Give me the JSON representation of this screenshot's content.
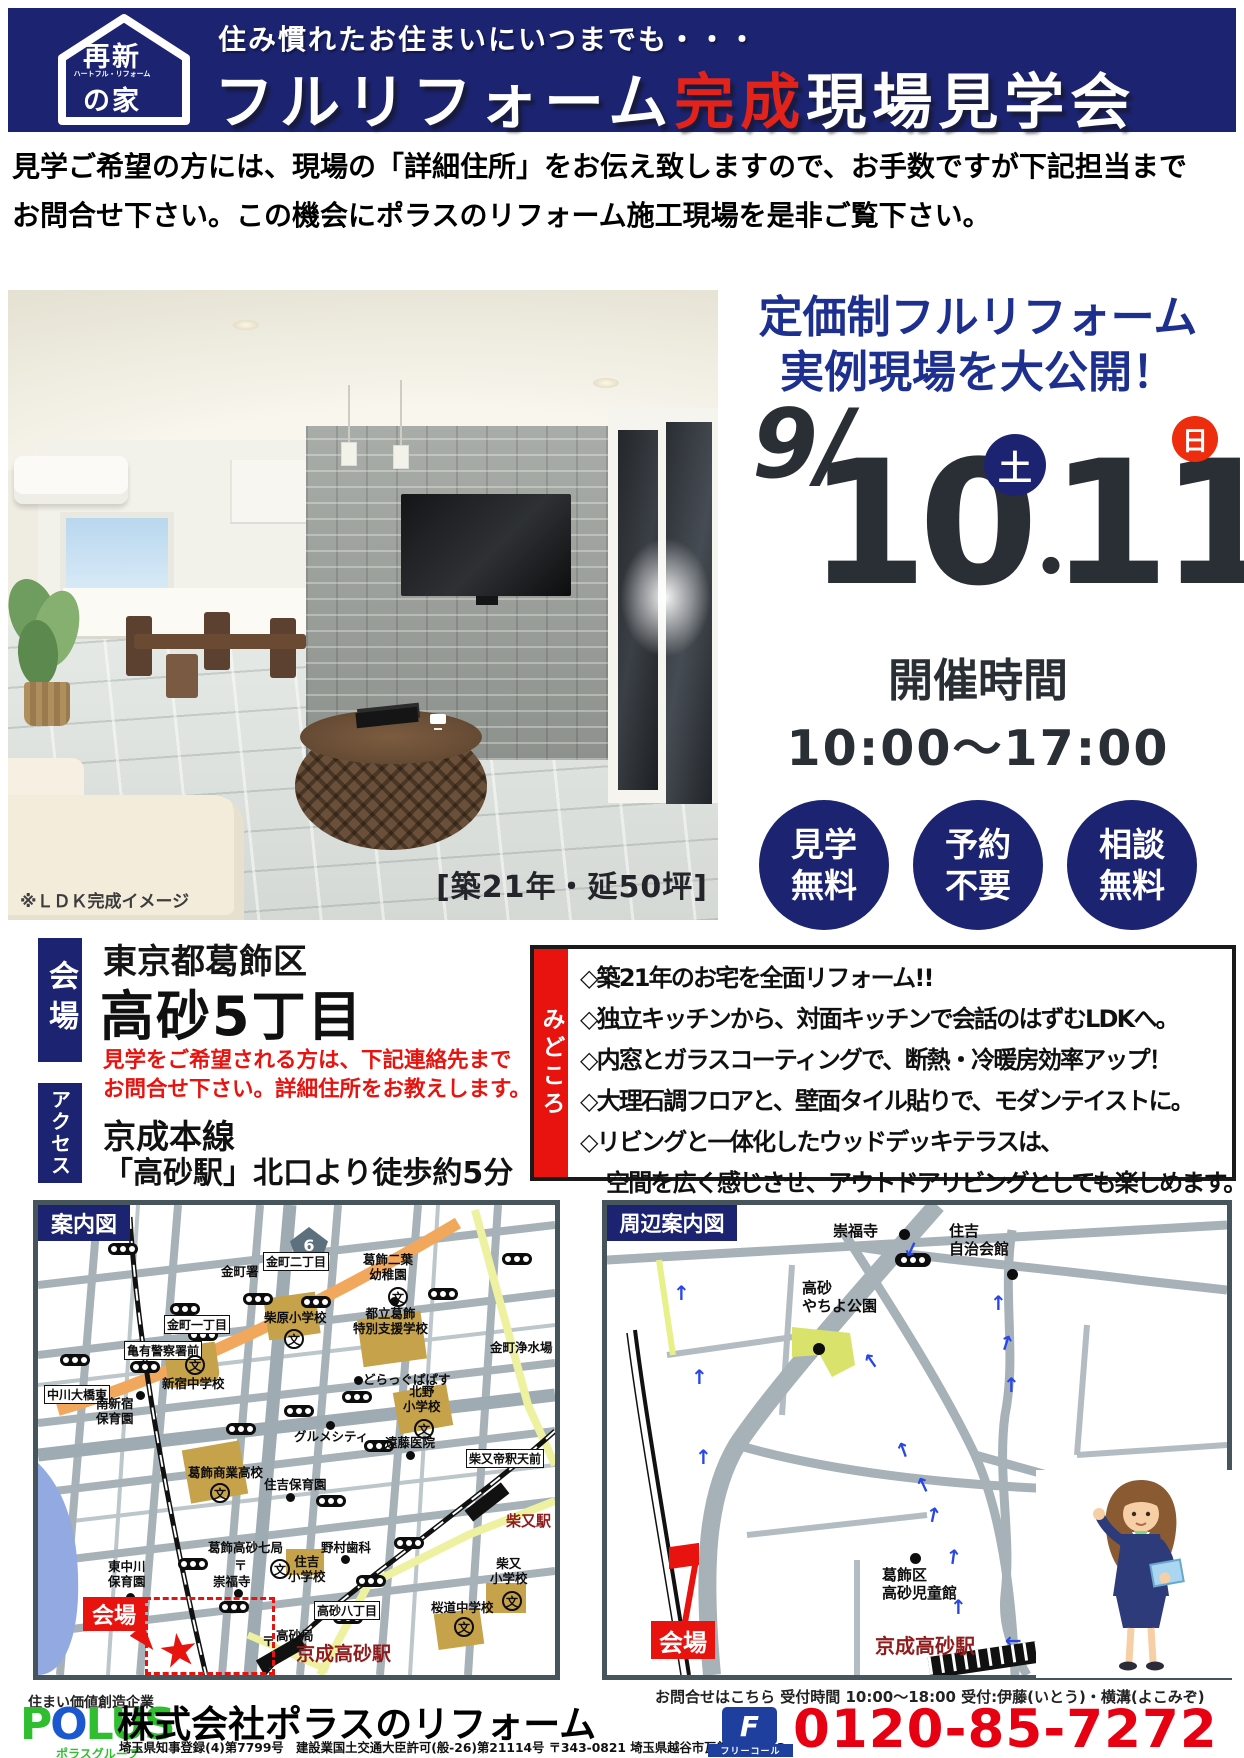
{
  "header": {
    "logo_top": "再新",
    "logo_mid": "ハートフル・リフォーム",
    "logo_bottom": "の家",
    "subtitle": "住み慣れたお住まいにいつまでも・・・",
    "title_pre": "フルリフォーム",
    "title_accent": "完成",
    "title_post": "現場見学会"
  },
  "intro": {
    "line1": "見学ご希望の方には、現場の「詳細住所」をお伝え致しますので、お手数ですが下記担当まで",
    "line2": "お問合せ下さい。この機会にポラスのリフォーム施工現場を是非ご覧下さい。"
  },
  "photo": {
    "caption": "※ＬＤＫ完成イメージ",
    "spec": "[築21年・延50坪]"
  },
  "promo": {
    "headline1": "定価制フルリフォーム",
    "headline2": "実例現場を大公開！",
    "month_day": "9/",
    "day1": "10",
    "day1_dow": "土",
    "dot": "・",
    "day2": "11",
    "day2_dow": "日",
    "hours_title": "開催時間",
    "hours": "10:00～17:00",
    "badge1_top": "見学",
    "badge1_bottom": "無料",
    "badge2_top": "予約",
    "badge2_bottom": "不要",
    "badge3_top": "相談",
    "badge3_bottom": "無料"
  },
  "venue": {
    "label": "会場",
    "city": "東京都葛飾区",
    "town": "高砂5丁目",
    "note1": "見学をご希望される方は、下記連絡先まで",
    "note2": "お問合せ下さい。詳細住所をお教えします。",
    "access_label": "アクセス",
    "access_line1": "京成本線",
    "access_line2": "「高砂駅」北口より徒歩約5分"
  },
  "highlights": {
    "label": "みどころ",
    "item1": "◇築21年のお宅を全面リフォーム!!",
    "item2": "◇独立キッチンから、対面キッチンで会話のはずむLDKへ。",
    "item3": "◇内窓とガラスコーティングで、断熱・冷暖房効率アップ！",
    "item4": "◇大理石調フロアと、壁面タイル貼りで、モダンテイストに。",
    "item5a": "◇リビングと一体化したウッドデッキテラスは、",
    "item5b": "空間を広く感じさせ、アウトドアリビングとしても楽しめます。"
  },
  "map_left": {
    "title": "案内図",
    "route_number": "6",
    "labels": {
      "kanamachi_nichome": "金町二丁目",
      "futaba_kindergarten": "葛飾二葉\n幼稚園",
      "kanamachi_sho": "金町署",
      "kanamachi_itchome": "金町一丁目",
      "kameari_police": "亀有警察署前",
      "shibahara_es": "柴原小学校",
      "katsushika_school": "都立葛飾\n特別支援学校",
      "josuijo": "金町浄水場",
      "shinjuku_jhs": "新宿中学校",
      "drugstore": "どらっぐぱぱす",
      "kitano_es": "北野\n小学校",
      "nakagawa_ohashi": "中川大橋東",
      "minami_hoikuen": "南新宿\n保育園",
      "gourmet_city": "グルメシティ",
      "endo_clinic": "遠藤医院",
      "taishakuten": "柴又帝釈天前",
      "shogyo_hs": "葛飾商業高校",
      "sumiyoshi_hoikuen": "住吉保育園",
      "shibamata_sta": "柴又駅",
      "takasago_post7": "葛飾高砂七局",
      "nomura_dental": "野村歯科",
      "sumiyoshi_es": "住吉\n小学校",
      "higashinakagawa_hoikuen": "東中川\n保育園",
      "sofukuji": "崇福寺",
      "venue": "会場",
      "takasago_hatchome": "高砂八丁目",
      "sakuramichi_jhs": "桜道中学校",
      "takasago_post": "高砂局",
      "keisei_takasago_sta": "京成高砂駅",
      "shibamata_es": "柴又\n小学校"
    }
  },
  "map_right": {
    "title": "周辺案内図",
    "labels": {
      "sofukuji": "崇福寺",
      "sumiyoshi_hall": "住吉\n自治会館",
      "yachiyo_park": "高砂\nやちよ公園",
      "jidokan": "葛飾区\n高砂児童館",
      "venue": "会場",
      "keisei_takasago_sta": "京成高砂駅"
    }
  },
  "symbols": {
    "school": "文",
    "post": "〒",
    "star": "★",
    "arrow": "↑"
  },
  "footer": {
    "tagline": "住まい価値創造企業",
    "logo_part1": "P",
    "logo_part2": "O",
    "logo_part3": "LUS",
    "logo_sub": "ポラスグループ",
    "company": "株式会社ポラスのリフォーム",
    "license": "埼玉県知事登録(4)第7799号　建設業国土交通大臣許可(般-26)第21114号 〒343-0821 埼玉県越谷市瓦曽根3-8-43",
    "contact": "お問合せはこちら 受付時間 10:00～18:00 受付:伊藤(いとう)・横溝(よこみぞ)",
    "freecall_mark": "F",
    "freecall_label": "フリーコール",
    "phone": "0120-85-7272"
  },
  "colors": {
    "navy": "#1c2472",
    "accent_red": "#e8130e",
    "phone_red": "#e60012",
    "station_dark_red": "#8e1c1c"
  }
}
